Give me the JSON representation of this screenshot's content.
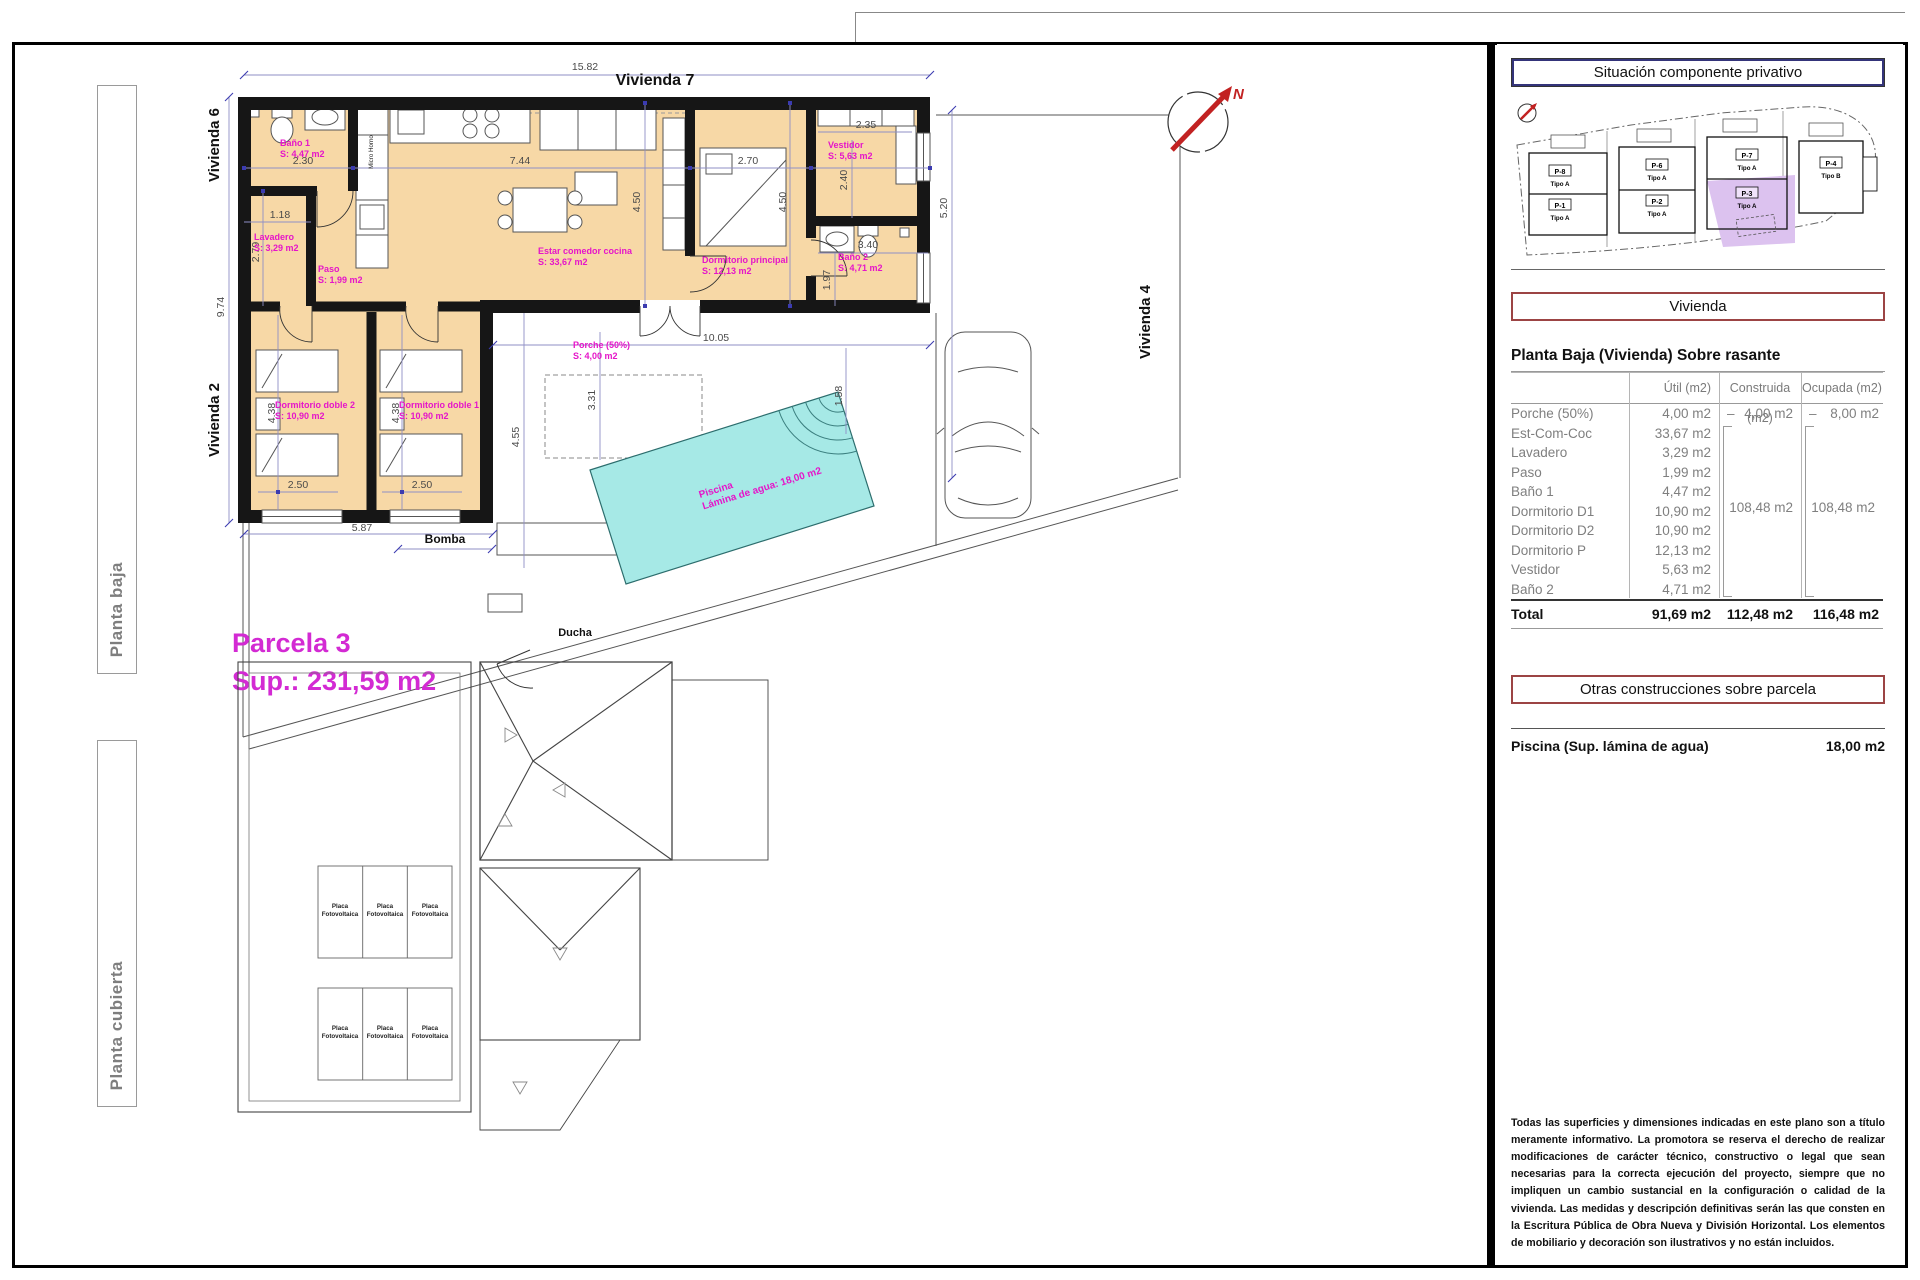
{
  "sheet": {
    "planta_baja_label": "Planta baja",
    "planta_cubierta_label": "Planta cubierta"
  },
  "plan": {
    "vivienda6": "Vivienda 6",
    "vivienda2": "Vivienda 2",
    "vivienda7": "Vivienda 7",
    "vivienda4": "Vivienda 4",
    "north_label": "N",
    "parcela_title": "Parcela 3",
    "parcela_sup": "Sup.: 231,59 m2",
    "bomba_label": "Bomba",
    "ducha_label": "Ducha",
    "kitchen_unit_label": "Micro Horno",
    "porch": {
      "name": "Porche (50%)",
      "area": "S: 4,00 m2"
    },
    "pool": {
      "name": "Piscina",
      "area": "Lámina de agua: 18,00 m2"
    },
    "rooms": [
      {
        "name": "Baño 1",
        "area": "S: 4,47 m2"
      },
      {
        "name": "Lavadero",
        "area": "S: 3,29 m2"
      },
      {
        "name": "Paso",
        "area": "S: 1,99 m2"
      },
      {
        "name": "Estar comedor cocina",
        "area": "S: 33,67 m2"
      },
      {
        "name": "Dormitorio principal",
        "area": "S: 12,13 m2"
      },
      {
        "name": "Vestidor",
        "area": "S: 5,63 m2"
      },
      {
        "name": "Baño 2",
        "area": "S: 4,71 m2"
      },
      {
        "name": "Dormitorio doble 2",
        "area": "S: 10,90 m2"
      },
      {
        "name": "Dormitorio doble 1",
        "area": "S: 10,90 m2"
      }
    ],
    "dims": [
      "15.82",
      "9.74",
      "2.30",
      "7.44",
      "2.70",
      "1.18",
      "2.79",
      "4.50",
      "4.50",
      "2.35",
      "2.40",
      "3.40",
      "1.97",
      "5.20",
      "10.05",
      "3.31",
      "4.55",
      "1.58",
      "2.50",
      "2.50",
      "4.38",
      "4.38",
      "5.87"
    ]
  },
  "roof": {
    "panel_label_line1": "Placa",
    "panel_label_line2": "Fotovoltaica"
  },
  "panel": {
    "situacion_title": "Situación componente privativo",
    "site": {
      "parcels": [
        {
          "id": "P-8",
          "tipo": "Tipo A"
        },
        {
          "id": "P-1",
          "tipo": "Tipo A"
        },
        {
          "id": "P-6",
          "tipo": "Tipo A"
        },
        {
          "id": "P-2",
          "tipo": "Tipo A"
        },
        {
          "id": "P-7",
          "tipo": "Tipo A"
        },
        {
          "id": "P-3",
          "tipo": "Tipo A"
        },
        {
          "id": "P-4",
          "tipo": "Tipo B"
        }
      ]
    },
    "vivienda_title": "Vivienda",
    "table": {
      "title": "Planta Baja (Vivienda) Sobre rasante",
      "col_util": "Útil (m2)",
      "col_construida": "Construida (m2)",
      "col_ocupada": "Ocupada (m2)",
      "rows": [
        {
          "name": "Porche (50%)",
          "util": "4,00 m2",
          "dash": "–",
          "construida": "4,00 m2",
          "ocupada": "8,00 m2"
        },
        {
          "name": "Est-Com-Coc",
          "util": "33,67 m2"
        },
        {
          "name": "Lavadero",
          "util": "3,29 m2"
        },
        {
          "name": "Paso",
          "util": "1,99 m2"
        },
        {
          "name": "Baño 1",
          "util": "4,47 m2"
        },
        {
          "name": "Dormitorio D1",
          "util": "10,90 m2"
        },
        {
          "name": "Dormitorio D2",
          "util": "10,90 m2"
        },
        {
          "name": "Dormitorio P",
          "util": "12,13 m2"
        },
        {
          "name": "Vestidor",
          "util": "5,63 m2"
        },
        {
          "name": "Baño 2",
          "util": "4,71 m2"
        }
      ],
      "construida_group": "108,48 m2",
      "ocupada_group": "108,48 m2",
      "total": {
        "label": "Total",
        "util": "91,69 m2",
        "construida": "112,48 m2",
        "ocupada": "116,48 m2"
      }
    },
    "otras_title": "Otras construcciones sobre parcela",
    "piscina_label": "Piscina (Sup. lámina de agua)",
    "piscina_value": "18,00 m2",
    "disclaimer": "Todas las superficies y dimensiones indicadas en este plano son a título meramente informativo. La promotora se reserva el derecho de realizar modificaciones de carácter técnico, constructivo o legal que sean necesarias para la correcta ejecución del proyecto, siempre que no impliquen un cambio sustancial en la configuración o calidad de la vivienda. Las medidas y descripción definitivas serán las que consten en la Escritura Pública de Obra Nueva y División Horizontal. Los elementos de mobiliario y decoración son ilustrativos y no están incluidos."
  }
}
